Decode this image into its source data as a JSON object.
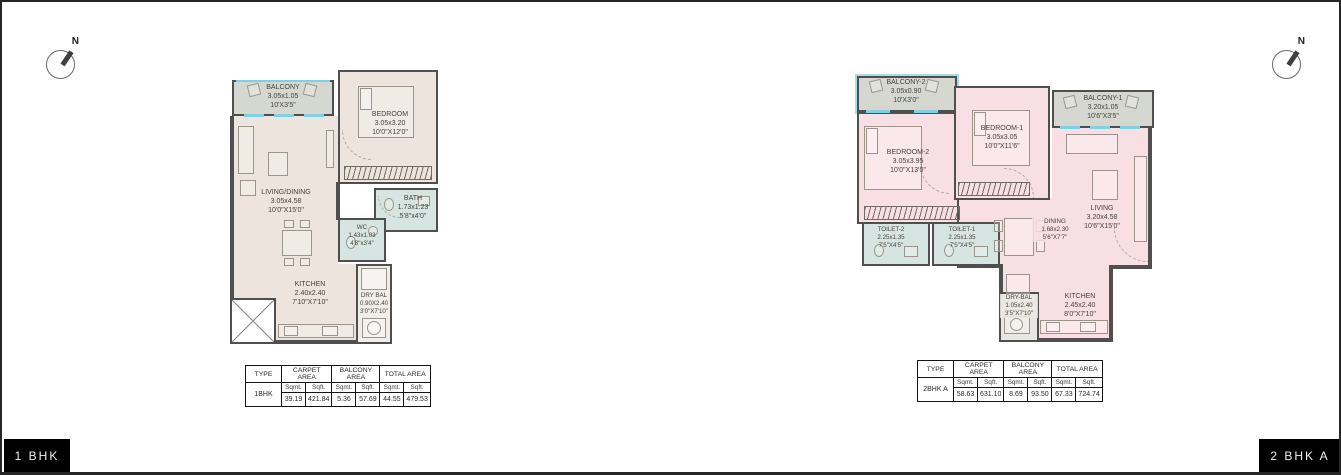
{
  "colors": {
    "wall": "#4f4f4f",
    "room_beige": "#ece4dd",
    "room_pink": "#f8dfe3",
    "balcony_gray": "#d5d8d0",
    "wet_teal": "#d6e5e1",
    "window_blue": "#7fd0e4",
    "tag_black": "#000000"
  },
  "compass": {
    "n_label": "N"
  },
  "footer": {
    "left_tag": "1 BHK",
    "right_tag": "2 BHK A"
  },
  "plan_1bhk": {
    "rooms": {
      "balcony": {
        "label": "BALCONY",
        "m": "3.05x1.05",
        "ft": "10'X3'5\""
      },
      "bedroom": {
        "label": "BEDROOM",
        "m": "3.05x3.20",
        "ft": "10'0\"X12'0\""
      },
      "living": {
        "label": "LIVING/DINING",
        "m": "3.05x4.58",
        "ft": "10'0\"X15'0\""
      },
      "bath": {
        "label": "BATH",
        "m": "1.73x1.23",
        "ft": "5'8\"x4'0\""
      },
      "wc": {
        "label": "WC",
        "m": "1.43x1.03",
        "ft": "4'8\"x3'4\""
      },
      "kitchen": {
        "label": "KITCHEN",
        "m": "2.40x2.40",
        "ft": "7'10\"X7'10\""
      },
      "drybal": {
        "label": "DRY BAL",
        "m": "0.90X2.40",
        "ft": "3'0\"X7'10\""
      }
    },
    "table": {
      "type_header": "TYPE",
      "carpet_header": "CARPET AREA",
      "balcony_header": "BALCONY AREA",
      "total_header": "TOTAL AREA",
      "sqmt": "Sqmt.",
      "sqft": "Sqft.",
      "type_value": "1BHK",
      "carpet_sqmt": "39.19",
      "carpet_sqft": "421.84",
      "balcony_sqmt": "5.36",
      "balcony_sqft": "57.69",
      "total_sqmt": "44.55",
      "total_sqft": "479.53"
    }
  },
  "plan_2bhk": {
    "rooms": {
      "balcony2": {
        "label": "BALCONY-2",
        "m": "3.05x0.90",
        "ft": "10'X3'0\""
      },
      "bedroom2": {
        "label": "BEDROOM-2",
        "m": "3.05x3.95",
        "ft": "10'0\"X13'0\""
      },
      "bedroom1": {
        "label": "BEDROOM-1",
        "m": "3.05x3.05",
        "ft": "10'0\"X11'6\""
      },
      "balcony1": {
        "label": "BALCONY-1",
        "m": "3.20x1.05",
        "ft": "10'6\"X3'5\""
      },
      "living": {
        "label": "LIVING",
        "m": "3.20x4.58",
        "ft": "10'6\"X15'0\""
      },
      "dining": {
        "label": "DINING",
        "m": "1.68x2.30",
        "ft": "5'6\"X7'7\""
      },
      "toilet2": {
        "label": "TOILET-2",
        "m": "2.25x1.35",
        "ft": "7'5\"X4'5\""
      },
      "toilet1": {
        "label": "TOILET-1",
        "m": "2.25x1.35",
        "ft": "7'5\"X4'5\""
      },
      "drybal": {
        "label": "DRY-BAL",
        "m": "1.05x2.40",
        "ft": "3'5\"X7'10\""
      },
      "kitchen": {
        "label": "KITCHEN",
        "m": "2.45x2.40",
        "ft": "8'0\"X7'10\""
      }
    },
    "table": {
      "type_header": "TYPE",
      "carpet_header": "CARPET AREA",
      "balcony_header": "BALCONY AREA",
      "total_header": "TOTAL AREA",
      "sqmt": "Sqmt.",
      "sqft": "Sqft.",
      "type_value": "2BHK A",
      "carpet_sqmt": "58.63",
      "carpet_sqft": "631.10",
      "balcony_sqmt": "8.69",
      "balcony_sqft": "93.50",
      "total_sqmt": "67.33",
      "total_sqft": "724.74"
    }
  }
}
